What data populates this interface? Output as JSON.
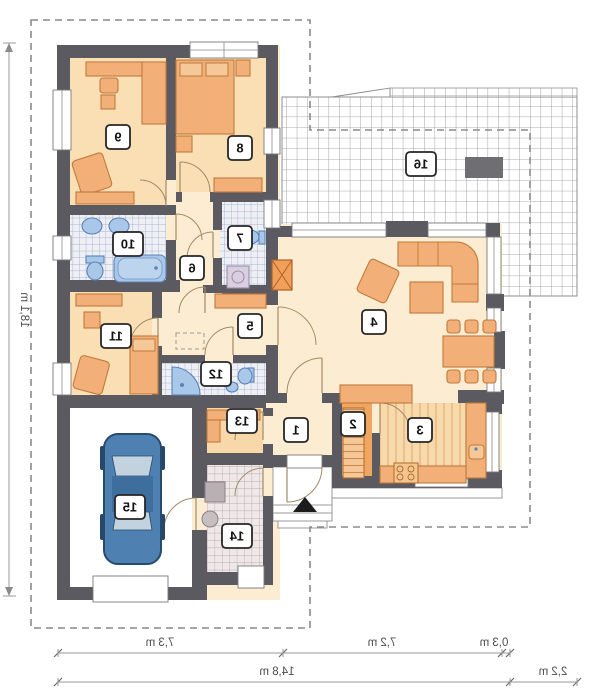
{
  "rooms": [
    {
      "number": "1"
    },
    {
      "number": "2"
    },
    {
      "number": "3"
    },
    {
      "number": "4"
    },
    {
      "number": "5"
    },
    {
      "number": "6"
    },
    {
      "number": "7"
    },
    {
      "number": "8"
    },
    {
      "number": "9"
    },
    {
      "number": "10"
    },
    {
      "number": "11"
    },
    {
      "number": "12"
    },
    {
      "number": "13"
    },
    {
      "number": "14"
    },
    {
      "number": "15"
    },
    {
      "number": "16"
    }
  ],
  "dimensions": {
    "bottom_upper": [
      "7,3 m",
      "7,2 m",
      "0,3 m"
    ],
    "bottom_lower": [
      "14,8 m",
      "2,2 m"
    ],
    "left": "18,1 m"
  },
  "colors": {
    "wall": "#5a5a60",
    "bedroom_floor": "#fbdfb4",
    "hall_floor": "#fcecd2",
    "furniture_fill": "#f2b078",
    "furniture_stroke": "#bf7a3c",
    "fixture_fill": "#a9c7e8",
    "fixture_stroke": "#5b83b8",
    "car_body": "#4f80b2",
    "kitchen_counter": "#eda05f",
    "boundary_line": "#8a8a8a"
  }
}
